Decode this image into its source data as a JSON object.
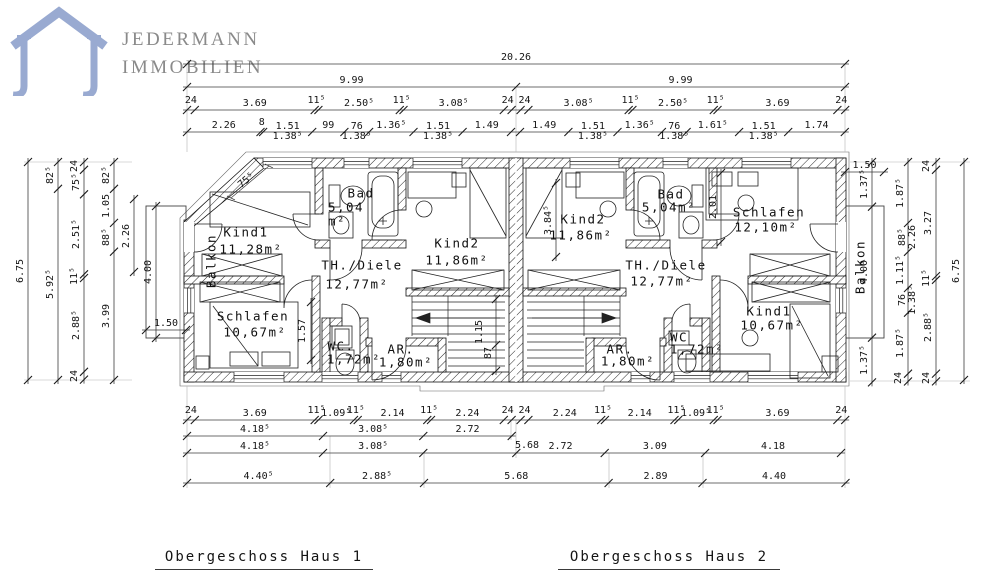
{
  "logo": {
    "line1": "JEDERMANN",
    "line2": "IMMOBILIEN",
    "icon": "house-outline-icon",
    "icon_color": "#99aad1",
    "text_color": "#8a8a8a"
  },
  "titles": {
    "house1": "Obergeschoss Haus 1",
    "house2": "Obergeschoss Haus 2"
  },
  "colors": {
    "background": "#ffffff",
    "drawing_line": "#1b1b1b",
    "dimension_line": "#3c3c3c"
  },
  "dims": {
    "top_overall": [
      "20.26"
    ],
    "top_halves": [
      "9.99",
      "9.99"
    ],
    "top_row3": [
      "24",
      "3.69",
      "11⁵",
      "2.50⁵",
      "11⁵",
      "3.08⁵",
      "24",
      "",
      "24",
      "3.08⁵",
      "11⁵",
      "2.50⁵",
      "11⁵",
      "3.69",
      "24"
    ],
    "top_row4": [
      "2.26",
      "8",
      "1.51\n1.38⁵",
      "99",
      "76\n1.38⁵",
      "1.36⁵",
      "1.51\n1.38⁵",
      "1.49",
      "",
      "1.49",
      "1.51\n1.38⁵",
      "1.36⁵",
      "76\n1.38⁵",
      "1.61⁵",
      "1.51\n1.38⁵",
      "1.74"
    ],
    "bottom_row1": [
      "24",
      "3.69",
      "11⁵",
      "1.09⁵",
      "11⁵",
      "2.14",
      "11⁵",
      "2.24",
      "24",
      "",
      "24",
      "2.24",
      "11⁵",
      "2.14",
      "11⁵",
      "1.09⁵",
      "11⁵",
      "3.69",
      "24"
    ],
    "bottom_row2": [
      "4.18⁵",
      "3.08⁵",
      "2.72"
    ],
    "bottom_row3": [
      "4.18⁵",
      "3.08⁵",
      "",
      "2.72",
      "3.09",
      "4.18"
    ],
    "bottom_row4": [
      "4.40⁵",
      "2.88⁵",
      "5.68",
      "2.89",
      "4.40"
    ],
    "left_c1": [
      "6.75"
    ],
    "left_c2": [
      "82⁵",
      "5.92⁵"
    ],
    "left_c3": [
      "24",
      "75⁵",
      "2.51⁵",
      "11⁵",
      "2.88⁵",
      "24"
    ],
    "left_c4": [
      "82⁵",
      "1.05",
      "88⁵",
      "3.99"
    ],
    "left_balcony_v": [
      "4.00"
    ],
    "left_balcony_h": [
      "1.50"
    ],
    "right_balcony_v": [
      "1.37⁵",
      "4.00",
      "1.37⁵"
    ],
    "right_balcony_h": [
      "1.50"
    ],
    "right_c1": [
      "1.87⁵",
      "88⁵\n2.26",
      "1.11⁵",
      "76\n1.38⁵",
      "1.87⁵",
      "24"
    ],
    "right_c2": [
      "24",
      "3.27",
      "11⁵",
      "2.88⁵",
      "24"
    ],
    "right_c3": [
      "6.75"
    ]
  },
  "floating": [
    {
      "t": "75⁵",
      "x": 247,
      "y": 181,
      "r": -40
    },
    {
      "t": "1.57",
      "x": 303,
      "y": 331,
      "r": -90
    },
    {
      "t": "1.15",
      "x": 480,
      "y": 332,
      "r": -90
    },
    {
      "t": "87",
      "x": 489,
      "y": 353,
      "r": -90
    },
    {
      "t": "3.84⁵",
      "x": 549,
      "y": 220,
      "r": -90
    },
    {
      "t": "2.01",
      "x": 714,
      "y": 207,
      "r": -90
    },
    {
      "t": "5.68",
      "x": 527,
      "y": 446,
      "r": 0
    },
    {
      "t": "2.26",
      "x": 127,
      "y": 236,
      "r": -90
    }
  ],
  "rooms": [
    {
      "t": "Kind1",
      "x": 246,
      "y": 233
    },
    {
      "t": "11,28m²",
      "x": 251,
      "y": 250
    },
    {
      "t": "Bad",
      "x": 361,
      "y": 194
    },
    {
      "t": "5,04",
      "x": 346,
      "y": 208
    },
    {
      "t": "m²",
      "x": 337,
      "y": 222
    },
    {
      "t": "Kind2",
      "x": 457,
      "y": 244
    },
    {
      "t": "11,86m²",
      "x": 457,
      "y": 261
    },
    {
      "t": "TH./Diele",
      "x": 362,
      "y": 266
    },
    {
      "t": "12,77m²",
      "x": 357,
      "y": 285
    },
    {
      "t": "Schlafen",
      "x": 253,
      "y": 317
    },
    {
      "t": "10,67m²",
      "x": 255,
      "y": 333
    },
    {
      "t": "WC.",
      "x": 341,
      "y": 347
    },
    {
      "t": "1,72m²",
      "x": 354,
      "y": 360
    },
    {
      "t": "AR.",
      "x": 401,
      "y": 350
    },
    {
      "t": "1,80m²",
      "x": 406,
      "y": 363
    },
    {
      "t": "Balkon",
      "x": 212,
      "y": 261,
      "r": -90
    },
    {
      "t": "Kind2",
      "x": 583,
      "y": 220
    },
    {
      "t": "11,86m²",
      "x": 581,
      "y": 236
    },
    {
      "t": "Bad",
      "x": 671,
      "y": 195
    },
    {
      "t": "5,04m²",
      "x": 669,
      "y": 208
    },
    {
      "t": "Schlafen",
      "x": 769,
      "y": 213
    },
    {
      "t": "12,10m²",
      "x": 766,
      "y": 228
    },
    {
      "t": "TH./Diele",
      "x": 666,
      "y": 266
    },
    {
      "t": "12,77m²",
      "x": 662,
      "y": 282
    },
    {
      "t": "AR.",
      "x": 620,
      "y": 350
    },
    {
      "t": "1,80m²",
      "x": 628,
      "y": 362
    },
    {
      "t": "WC",
      "x": 679,
      "y": 338
    },
    {
      "t": "1,72m²",
      "x": 697,
      "y": 350
    },
    {
      "t": "Kind1",
      "x": 769,
      "y": 312
    },
    {
      "t": "10,67m²",
      "x": 772,
      "y": 326
    },
    {
      "t": "Balkon",
      "x": 861,
      "y": 267,
      "r": -90
    }
  ]
}
